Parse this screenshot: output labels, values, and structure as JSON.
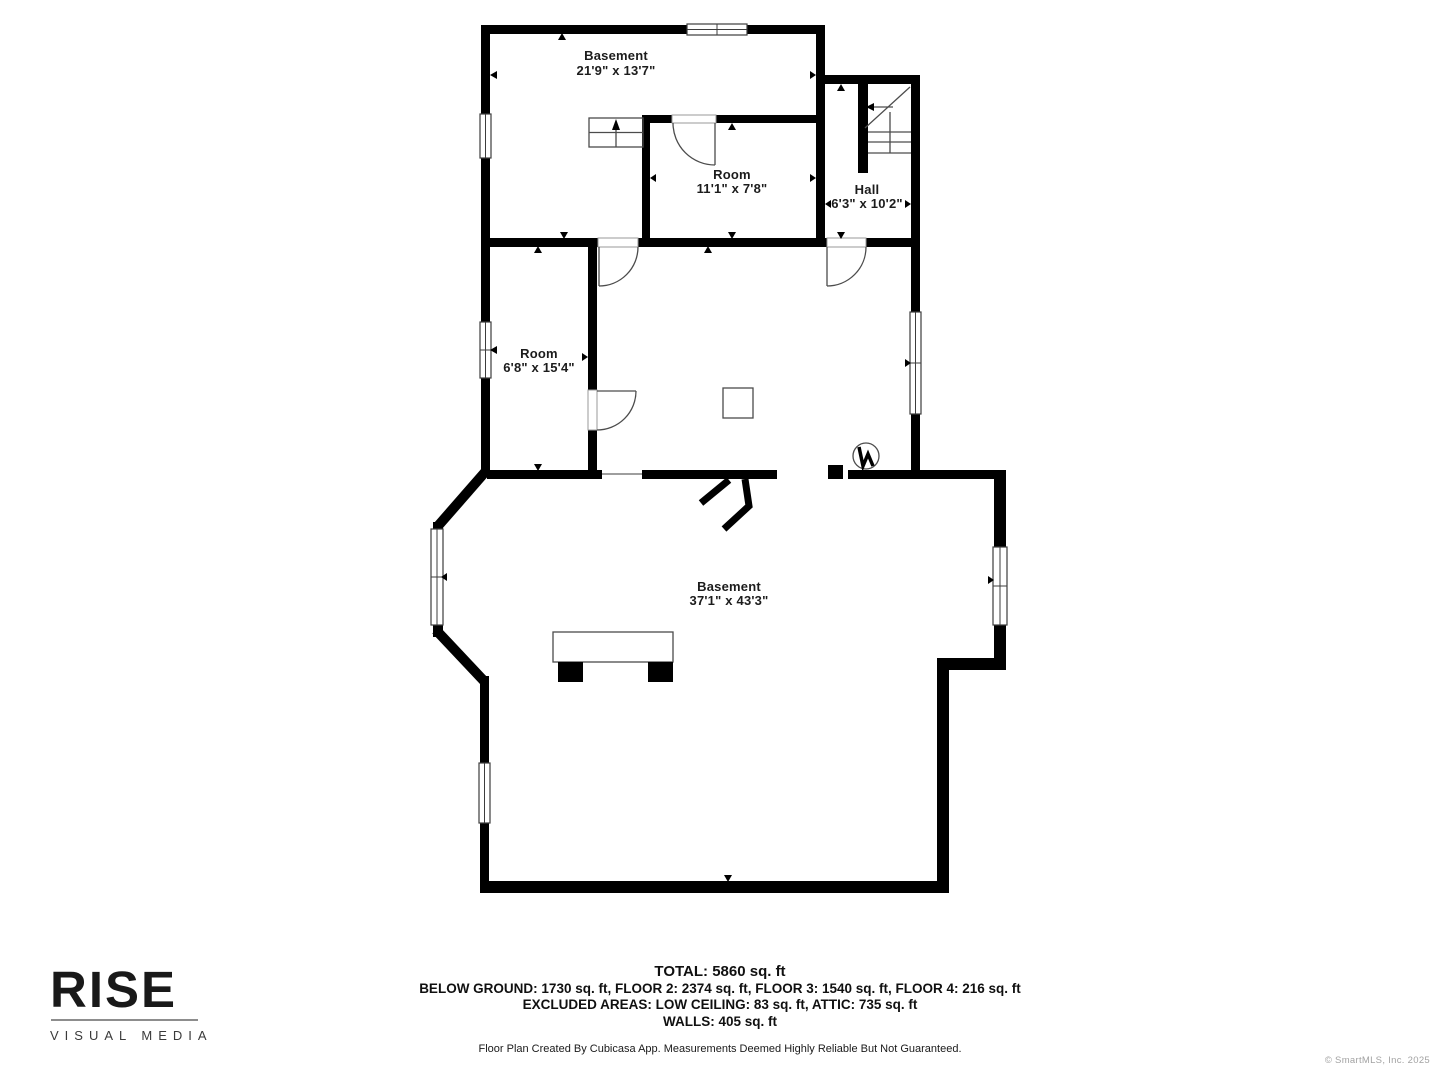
{
  "floorplan": {
    "rooms": [
      {
        "name": "Basement",
        "dims": "21'9\" x 13'7\""
      },
      {
        "name": "Room",
        "dims": "11'1\" x 7'8\""
      },
      {
        "name": "Hall",
        "dims": "6'3\" x 10'2\""
      },
      {
        "name": "Room",
        "dims": "6'8\" x 15'4\""
      },
      {
        "name": "Basement",
        "dims": "37'1\" x 43'3\""
      }
    ],
    "icons": [
      "window-icon",
      "door-icon",
      "stairs-icon",
      "stairs-up-arrow-icon",
      "stairs-direction-arrow-icon",
      "water-heater-icon",
      "double-door-open-icon",
      "table-furniture-icon",
      "square-fixture-icon",
      "measure-tick-icon"
    ],
    "colors": {
      "wall": "#000000",
      "thin_line": "#4c4c4c",
      "label_text": "#1c1c1c"
    }
  },
  "summary": {
    "total": "TOTAL: 5860 sq. ft",
    "floors": "BELOW GROUND: 1730 sq. ft, FLOOR 2: 2374 sq. ft, FLOOR 3: 1540 sq. ft, FLOOR 4: 216 sq. ft",
    "excluded": "EXCLUDED AREAS: LOW CEILING: 83 sq. ft, ATTIC: 735 sq. ft",
    "walls": "WALLS: 405 sq. ft",
    "disclaimer": "Floor Plan Created By Cubicasa App. Measurements Deemed Highly Reliable But Not Guaranteed."
  },
  "branding": {
    "logo": "RISE",
    "tagline": "VISUAL MEDIA"
  },
  "footer": {
    "copyright": "© SmartMLS, Inc.  2025"
  }
}
